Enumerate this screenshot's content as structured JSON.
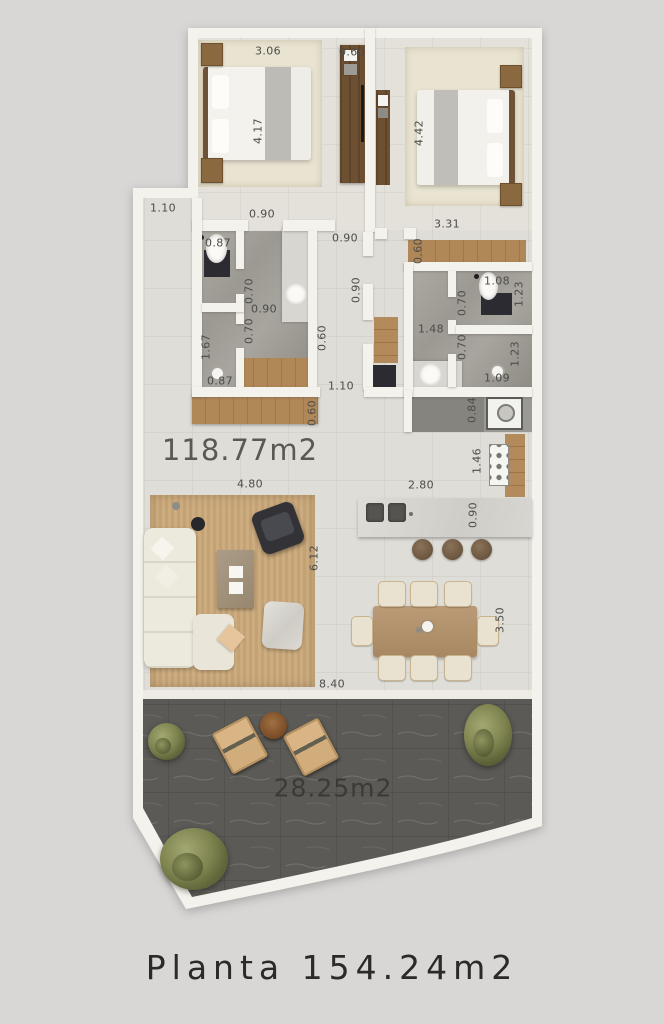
{
  "caption": "Planta 154.24m2",
  "areas": {
    "interior": "118.77m2",
    "terrace": "28.25m2"
  },
  "dimensions": {
    "bedroom1_width": "3.06",
    "bedroom1_wardrobe": "0.60",
    "bedroom1_length": "4.17",
    "bedroom2_length": "4.42",
    "bedroom2_width": "3.31",
    "bedroom2_wardrobe": "0.60",
    "left_recess": "1.10",
    "bath1_door": "0.90",
    "hall_door": "0.90",
    "bath1_wc_width": "0.87",
    "bath1_inner_door_top": "0.70",
    "bath1_center_width": "0.90",
    "bath1_inner_door_bottom": "0.70",
    "hall_width": "0.90",
    "bath1_shower_length": "1.67",
    "bath1_shower_width": "0.87",
    "hall_closet_depth": "0.60",
    "bath2_wc_width": "1.08",
    "bath2_wc_length": "1.23",
    "bath2_inner_door_top": "0.70",
    "bath2_center_width": "1.48",
    "bath2_inner_door_bottom": "0.70",
    "bath2_shower_length": "1.23",
    "bath2_shower_width": "1.09",
    "entry_passage": "1.10",
    "sideboard_depth": "0.60",
    "laundry_depth": "0.84",
    "kitchen_counter_length": "1.46",
    "island_length": "2.80",
    "island_depth": "0.90",
    "living_width": "4.80",
    "living_length": "6.12",
    "dining_length": "3.50",
    "total_width": "8.40"
  },
  "colors": {
    "background": "#d8d7d5",
    "wall": "#f4f2ec",
    "floor": "#dfddd7",
    "bedroom_floor": "#e4e1da",
    "bath_floor": "#a3a09a",
    "wood": "#a9835a",
    "terrace_stone": "#5b5a56",
    "label_text": "#4d4c48",
    "caption_text": "#2b2a28"
  }
}
